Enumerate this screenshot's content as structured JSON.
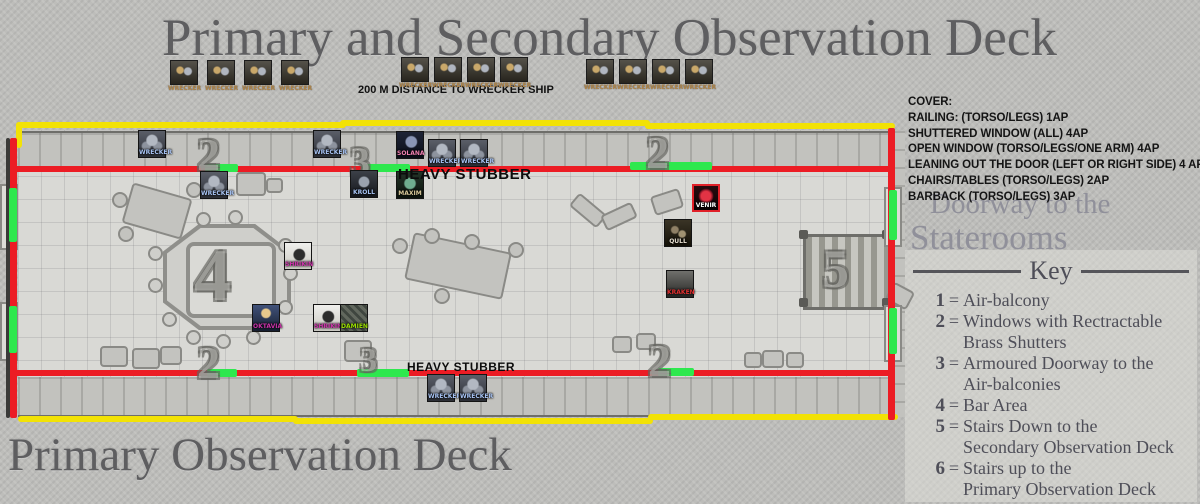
{
  "title_top": "Primary and Secondary Observation Deck",
  "title_bottom": "Primary Observation Deck",
  "distance_label": "200 M DISTANCE TO WRECKER SHIP",
  "ghost_text": {
    "line1": "Doorway to the",
    "line2": "Staterooms"
  },
  "cover_panel": {
    "heading": "COVER:",
    "lines": [
      "RAILING: (TORSO/LEGS) 1AP",
      "SHUTTERED WINDOW (ALL) 4AP",
      "OPEN WINDOW (TORSO/LEGS/ONE ARM) 4AP",
      "LEANING OUT THE DOOR (LEFT OR RIGHT SIDE) 4 AP",
      "CHAIRS/TABLES (TORSO/LEGS) 2AP",
      "BARBACK (TORSO/LEGS) 3AP"
    ]
  },
  "key_panel": {
    "title": "Key",
    "items": [
      {
        "num": "1",
        "lines": [
          "Air-balcony"
        ]
      },
      {
        "num": "2",
        "lines": [
          "Windows with Rectractable",
          "Brass Shutters"
        ]
      },
      {
        "num": "3",
        "lines": [
          "Armoured Doorway to the",
          "Air-balconies"
        ]
      },
      {
        "num": "4",
        "lines": [
          "Bar Area"
        ]
      },
      {
        "num": "5",
        "lines": [
          "Stairs Down to the",
          "Secondary Observation Deck"
        ]
      },
      {
        "num": "6",
        "lines": [
          "Stairs up to the",
          "Primary Observation Deck"
        ]
      }
    ]
  },
  "boarding_tokens": {
    "label": "WRECKER",
    "groups": [
      {
        "x": 168,
        "y": 60,
        "count": 4,
        "pitch": 37
      },
      {
        "x": 399,
        "y": 57,
        "count": 4,
        "pitch": 33
      },
      {
        "x": 584,
        "y": 59,
        "count": 4,
        "pitch": 33
      }
    ]
  },
  "map": {
    "numbers": [
      {
        "label": "2",
        "x": 197,
        "y": 128,
        "size": 46
      },
      {
        "label": "3",
        "x": 350,
        "y": 138,
        "size": 40
      },
      {
        "label": "2",
        "x": 646,
        "y": 126,
        "size": 46
      },
      {
        "label": "4",
        "x": 194,
        "y": 234,
        "size": 74
      },
      {
        "label": "5",
        "x": 822,
        "y": 238,
        "size": 54
      },
      {
        "label": "2",
        "x": 197,
        "y": 336,
        "size": 46
      },
      {
        "label": "3",
        "x": 360,
        "y": 342,
        "size": 34
      },
      {
        "label": "2",
        "x": 648,
        "y": 334,
        "size": 46
      }
    ],
    "stubber_labels": [
      {
        "text": "HEAVY STUBBER",
        "x": 398,
        "y": 166,
        "size": 15
      },
      {
        "text": "HEAVY STUBBER",
        "x": 407,
        "y": 360,
        "size": 12
      }
    ],
    "tokens": [
      {
        "label": "WRECKER",
        "x": 138,
        "y": 130,
        "style": "wrecker"
      },
      {
        "label": "WRECKER",
        "x": 200,
        "y": 171,
        "style": "wrecker"
      },
      {
        "label": "WRECKER",
        "x": 313,
        "y": 130,
        "style": "wrecker"
      },
      {
        "label": "SOLANA",
        "x": 396,
        "y": 131,
        "style": "solana"
      },
      {
        "label": "WRECKER",
        "x": 428,
        "y": 139,
        "style": "wrecker"
      },
      {
        "label": "WRECKER",
        "x": 460,
        "y": 139,
        "style": "wrecker"
      },
      {
        "label": "KROLL",
        "x": 350,
        "y": 170,
        "style": "kroll"
      },
      {
        "label": "MAXIM",
        "x": 396,
        "y": 171,
        "style": "maxim"
      },
      {
        "label": "SHRIKIN",
        "x": 284,
        "y": 242,
        "style": "raven"
      },
      {
        "label": "OKTAVIA",
        "x": 252,
        "y": 304,
        "style": "oktavia"
      },
      {
        "label": "SHRIKIN",
        "x": 313,
        "y": 304,
        "style": "raven"
      },
      {
        "label": "DAMIEN",
        "x": 340,
        "y": 304,
        "style": "damien"
      },
      {
        "label": "VENIR",
        "x": 692,
        "y": 184,
        "style": "venir"
      },
      {
        "label": "QULL",
        "x": 664,
        "y": 219,
        "style": "qull"
      },
      {
        "label": "KRAKEN",
        "x": 666,
        "y": 270,
        "style": "kraken"
      },
      {
        "label": "WRECKER",
        "x": 427,
        "y": 374,
        "style": "wrecker"
      },
      {
        "label": "WRECKER",
        "x": 459,
        "y": 374,
        "style": "wrecker"
      }
    ],
    "label_colors": {
      "wrecker": "#a6c2f2",
      "solana": "#f080b0",
      "kroll": "#a6c2f2",
      "maxim": "#d8c89a",
      "raven": "#cc33aa",
      "oktavia": "#cc33aa",
      "damien": "#9ade00",
      "venir": "#ffffff",
      "qull": "#e8e0d0",
      "kraken": "#e03030"
    }
  },
  "colors": {
    "outer_wall_yellow": "#f2e205",
    "inner_wall_red": "#ec1c24",
    "opening_green": "#2ee84e",
    "title_grey": "#5e5e60"
  }
}
